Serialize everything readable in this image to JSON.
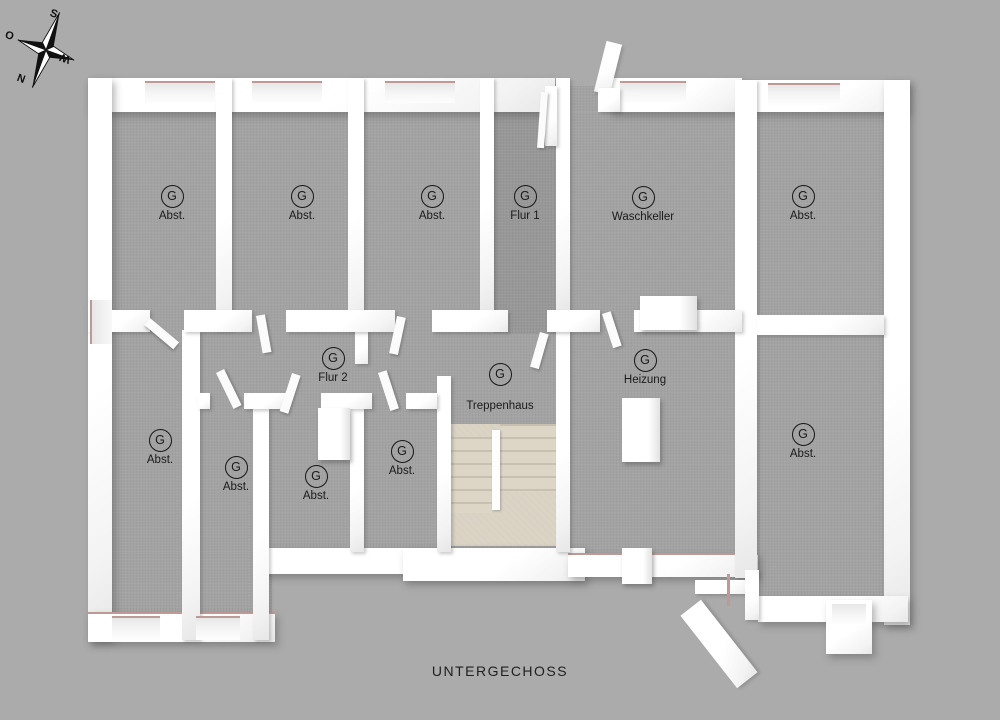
{
  "title": {
    "caption": "UNTERGECHOSS"
  },
  "compass": {
    "labels": {
      "top": "S",
      "left": "O",
      "right": "W",
      "bottom": "N"
    }
  },
  "rooms": [
    {
      "symbol": "G",
      "label": "Abst."
    },
    {
      "symbol": "G",
      "label": "Abst."
    },
    {
      "symbol": "G",
      "label": "Abst."
    },
    {
      "symbol": "G",
      "label": "Flur 1"
    },
    {
      "symbol": "G",
      "label": "Waschkeller"
    },
    {
      "symbol": "G",
      "label": "Abst."
    },
    {
      "symbol": "G",
      "label": "Flur 2"
    },
    {
      "symbol": "G",
      "label": "Treppenhaus"
    },
    {
      "symbol": "G",
      "label": "Heizung"
    },
    {
      "symbol": "G",
      "label": "Abst."
    },
    {
      "symbol": "G",
      "label": "Abst."
    },
    {
      "symbol": "G",
      "label": "Abst."
    },
    {
      "symbol": "G",
      "label": "Abst."
    },
    {
      "symbol": "G",
      "label": "Abst."
    }
  ],
  "colors": {
    "background": "#ababab",
    "floor": "#a3a3a3",
    "floor_dark": "#989898",
    "wall": "#ffffff",
    "stairs": "#d9d2c3",
    "sill_accent": "#bd9a95",
    "text": "#1a1a1a"
  }
}
